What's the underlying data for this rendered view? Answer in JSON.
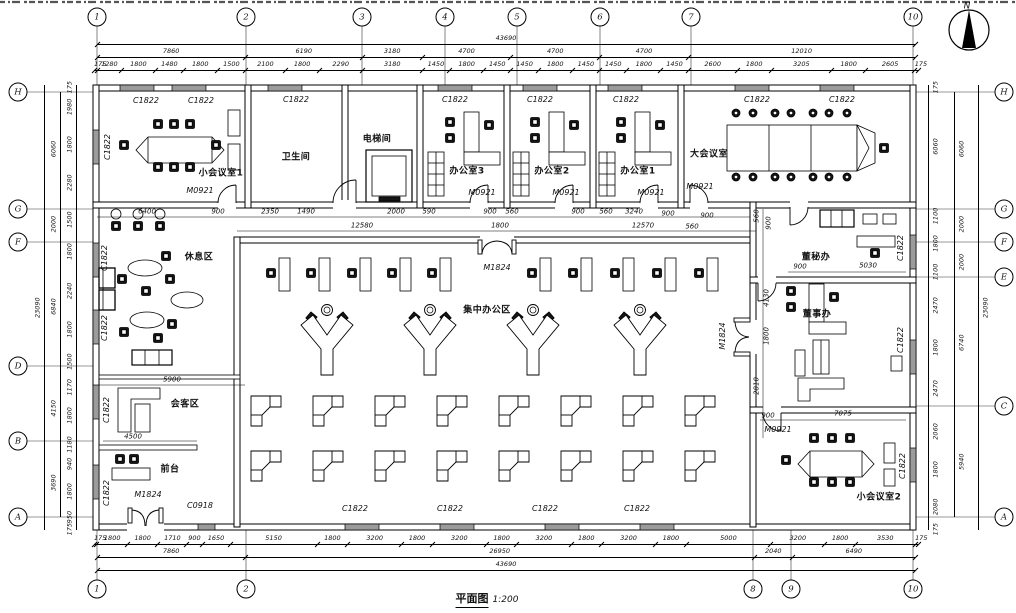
{
  "title": {
    "name": "平面图",
    "scale": "1:200"
  },
  "north": "N",
  "labels": {
    "c1822": "C1822",
    "c0918": "C0918",
    "m0921": "M0921",
    "m1824": "M1824"
  },
  "rooms": {
    "meeting1": "小会议室1",
    "toilet": "卫生间",
    "elevator": "电梯间",
    "office3": "办公室3",
    "office2": "办公室2",
    "office1": "办公室1",
    "bigmeeting": "大会议室",
    "rest": "休息区",
    "openoffice": "集中办公区",
    "guest": "会客区",
    "reception": "前台",
    "secretary": "董秘办",
    "director": "董事办",
    "meeting2": "小会议室2"
  },
  "axes": {
    "top": [
      "1",
      "2",
      "3",
      "4",
      "5",
      "6",
      "7",
      "10"
    ],
    "bottom": [
      "1",
      "2",
      "8",
      "9",
      "10"
    ],
    "left": [
      "H",
      "G",
      "F",
      "D",
      "B",
      "A"
    ],
    "right": [
      "H",
      "G",
      "F",
      "E",
      "C",
      "A"
    ]
  },
  "dims": {
    "top_total": [
      "43690"
    ],
    "top_seg": [
      "7860",
      "6190",
      "3180",
      "4700",
      "4700",
      "4700",
      "12010"
    ],
    "top_det": [
      "175",
      "1280",
      "1800",
      "1480",
      "1800",
      "1500",
      "2100",
      "1800",
      "2290",
      "3180",
      "1450",
      "1800",
      "1450",
      "1450",
      "1800",
      "1450",
      "1450",
      "1800",
      "1450",
      "2600",
      "1800",
      "3205",
      "1800",
      "2605",
      "175"
    ],
    "bot_det": [
      "175",
      "1800",
      "1800",
      "1710",
      "900",
      "1650",
      "5150",
      "1800",
      "3200",
      "1800",
      "3200",
      "1800",
      "3200",
      "1800",
      "3200",
      "1800",
      "5000",
      "3200",
      "1800",
      "3530",
      "175"
    ],
    "bot_seg": [
      "7860",
      "26950",
      "2040",
      "6490"
    ],
    "bot_total": [
      "43690"
    ],
    "left_det": [
      "175",
      "1980",
      "1800",
      "2280",
      "1500",
      "1800",
      "2240",
      "1800",
      "1500",
      "1170",
      "1800",
      "1180",
      "940",
      "1800",
      "950",
      "175"
    ],
    "left_seg": [
      "6060",
      "2000",
      "6840",
      "4150",
      "3690"
    ],
    "left_total": [
      "23090"
    ],
    "right_det": [
      "175",
      "6060",
      "1100",
      "1800",
      "1100",
      "2470",
      "1800",
      "2470",
      "2060",
      "1800",
      "2080",
      "175"
    ],
    "right_seg": [
      "6060",
      "2000",
      "2000",
      "6740",
      "5940"
    ],
    "right_total": [
      "23090"
    ],
    "interior": [
      "6400",
      "900",
      "2350",
      "1490",
      "2000",
      "590",
      "900",
      "560",
      "900",
      "560",
      "3240",
      "900",
      "900",
      "12580",
      "1800",
      "12570",
      "560",
      "560",
      "900",
      "900",
      "5030",
      "4130",
      "1800",
      "2810",
      "900",
      "7075",
      "5900",
      "4500"
    ]
  }
}
